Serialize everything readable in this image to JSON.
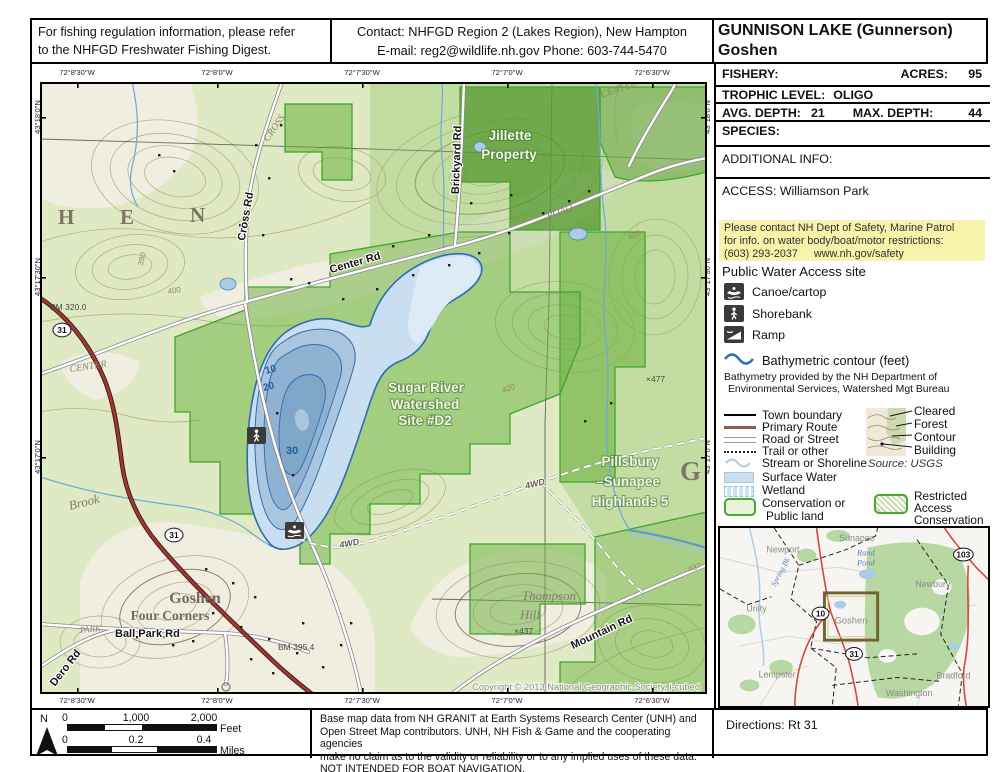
{
  "header": {
    "regulation_line1": "For fishing regulation information, please refer",
    "regulation_line2": "to the NHFGD Freshwater Fishing Digest.",
    "contact_line1": "Contact: NHFGD Region 2 (Lakes Region), New Hampton",
    "contact_line2": "E-mail: reg2@wildlife.nh.gov Phone: 603-744-5470",
    "title": "GUNNISON LAKE (Gunnerson)",
    "subtitle": "Goshen"
  },
  "info": {
    "fishery_label": "FISHERY:",
    "fishery_value": "",
    "acres_label": "ACRES:",
    "acres_value": "95",
    "trophic_label": "TROPHIC LEVEL:",
    "trophic_value": "OLIGO",
    "avg_depth_label": "AVG. DEPTH:",
    "avg_depth_value": "21",
    "max_depth_label": "MAX. DEPTH:",
    "max_depth_value": "44",
    "species_label": "SPECIES:",
    "additional_label": "ADDITIONAL INFO:",
    "access_text": "ACCESS: Williamson Park",
    "notice_line1": "Please contact NH Dept of Safety, Marine Patrol",
    "notice_line2": "for info. on water body/boat/motor restrictions:",
    "notice_phone": "(603) 293-2037",
    "notice_url": "www.nh.gov/safety",
    "notice_bg": "#f8f3ab"
  },
  "legend": {
    "access_title": "Public Water Access site",
    "canoe": "Canoe/cartop",
    "shorebank": "Shorebank",
    "ramp": "Ramp",
    "bathy": "Bathymetric contour (feet)",
    "bathy_note1": "Bathymetry provided by the NH Department of",
    "bathy_note2": "Environmental Services, Watershed Mgt Bureau",
    "town_boundary": "Town boundary",
    "primary_route": "Primary Route",
    "road_street": "Road or Street",
    "trail": "Trail or other",
    "stream": "Stream or Shoreline",
    "surface_water": "Surface Water",
    "wetland": "Wetland",
    "conservation1": "Conservation or",
    "conservation2": "Public land",
    "cleared": "Cleared",
    "forest": "Forest",
    "contour": "Contour",
    "building": "Building",
    "source": "Source:  USGS",
    "restricted1": "Restricted",
    "restricted2": "Access",
    "restricted3": "Conservation"
  },
  "map": {
    "coords_top": [
      "72°8'30\"W",
      "72°8'0\"W",
      "72°7'30\"W",
      "72°7'0\"W",
      "72°6'30\"W"
    ],
    "coords_bottom": [
      "72°8'30\"W",
      "72°8'0\"W",
      "72°7'30\"W",
      "72°7'0\"W",
      "72°6'30\"W"
    ],
    "coords_left": [
      "43°18'0\"N",
      "43°17'30\"N",
      "43°17'0\"N"
    ],
    "coords_right": [
      "43°18'0\"N",
      "43°17'30\"N",
      "43°17'0\"N"
    ],
    "labels": {
      "letter_h": "H",
      "letter_e": "E",
      "letter_n": "N",
      "letter_g": "G",
      "cross_rd": "Cross Rd",
      "cross_topo": "CROSS",
      "brickyard_rd": "Brickyard Rd",
      "jillette1": "Jillette",
      "jillette2": "Property",
      "center_rd": "Center Rd",
      "center_topo1": "CENTER",
      "center_topo2": "CENTER",
      "road_topo": "ROAD",
      "sugar1": "Sugar River",
      "sugar2": "Watershed",
      "sugar3": "Site #D2",
      "pillsbury1": "Pillsbury",
      "pillsbury2": "–Sunapee",
      "pillsbury3": "Highlands 5",
      "thompson1": "Thompson",
      "thompson2": "Hill",
      "mountain_rd": "Mountain Rd",
      "goshen1": "Goshen",
      "goshen2": "Four Corners",
      "ballpark_rd": "Ball Park Rd",
      "park_topo": "PARK",
      "dero_rd": "Dero Rd",
      "brook": "Brook",
      "bm320": "BM 320.0",
      "bm395": "BM 395.4",
      "route31": "31",
      "d10": "10",
      "d20": "20",
      "d30": "30",
      "fwd1": "4WD",
      "fwd2": "4WD",
      "e390": "390",
      "e400": "400",
      "e420a": "420",
      "e420b": "420",
      "e437": "×437",
      "e437b": "437",
      "e477": "×477",
      "copyright": "Copyright:© 2013 National Geographic Society, i-cubed"
    }
  },
  "inset": {
    "sunapee": "Sunapee",
    "newport": "Newport",
    "rand1": "Rand",
    "rand2": "Pond",
    "newbury": "Newbury",
    "unity": "Unity",
    "goshen": "Goshen",
    "lempster": "Lempster",
    "washington": "Washington",
    "bradford": "Bradford",
    "spring_bk": "Spring Bk",
    "s10": "10",
    "s31": "31",
    "s103": "103"
  },
  "footer": {
    "north": "N",
    "feet0": "0",
    "feet1": "1,000",
    "feet2": "2,000",
    "feet_unit": "Feet",
    "miles0": "0",
    "miles1": "0.2",
    "miles2": "0.4",
    "miles_unit": "Miles",
    "disc1": "Base map data from NH GRANIT at Earth Systems Research Center (UNH) and",
    "disc2": "Open Street Map contributors.  UNH, NH Fish & Game and the cooperating agencies",
    "disc3": "make no claim as to the validity or reliability or to any implied uses of these data.",
    "disc4": "NOT INTENDED FOR BOAT NAVIGATION.",
    "directions": "Directions: Rt 31"
  },
  "colors": {
    "notice_yellow": "#f8f3ab",
    "surface_water": "#c9dff0",
    "deep_water": "#8fb2d2",
    "conservation_green": "#62af34",
    "route_red": "#9c3a32",
    "contour_brown": "#b49a74"
  }
}
